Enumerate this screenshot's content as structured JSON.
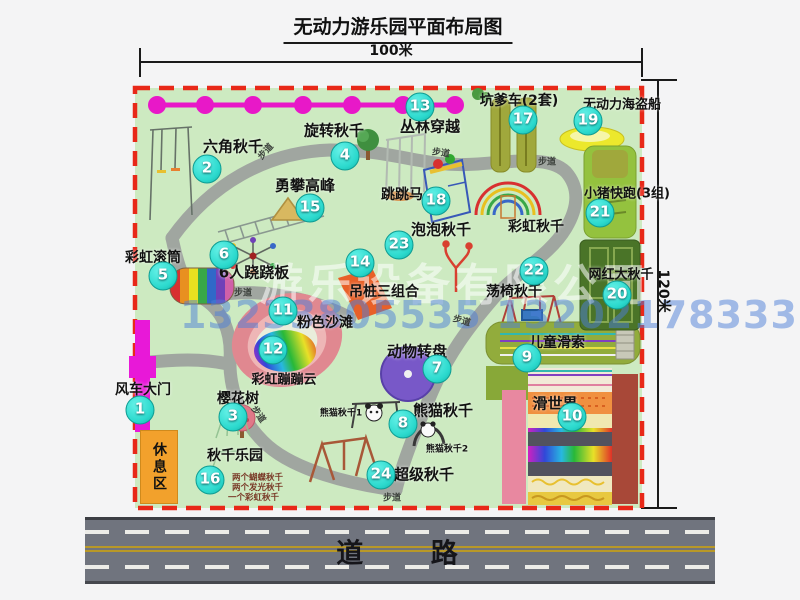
{
  "title": "无动力游乐园平面布局图",
  "scale": {
    "top": "100米",
    "right": "120米"
  },
  "watermark": {
    "company": "游乐设备有限公司",
    "phone": "13233805535 13202178333"
  },
  "road": {
    "label": "道    路"
  },
  "rest_area": {
    "label": "休息区"
  },
  "trail": {
    "label": "步道"
  },
  "extra_labels": {
    "rainbow_swing": "彩虹秋千",
    "panda_swing_1": "熊猫秋千1",
    "panda_swing_2": "熊猫秋千2"
  },
  "swing_park_notes": [
    "两个蝴蝶秋千",
    "两个发光秋千",
    "一个彩虹秋千"
  ],
  "colors": {
    "map_green": "#cdeac1",
    "border_red": "#e82818",
    "path_gray": "#a0a6a0",
    "chain_magenta": "#e818c8",
    "badge_cyan": "#2bd9cd",
    "rest_orange": "#f2a12c"
  },
  "attractions": [
    {
      "num": "1",
      "name": "风车大门"
    },
    {
      "num": "2",
      "name": "六角秋千"
    },
    {
      "num": "3",
      "name": "樱花树"
    },
    {
      "num": "4",
      "name": "旋转秋千"
    },
    {
      "num": "5",
      "name": "彩虹滚筒"
    },
    {
      "num": "6",
      "name": "6人跷跷板"
    },
    {
      "num": "7",
      "name": "动物转盘"
    },
    {
      "num": "8",
      "name": "熊猫秋千"
    },
    {
      "num": "9",
      "name": "儿童滑索"
    },
    {
      "num": "10",
      "name": "滑世界"
    },
    {
      "num": "11",
      "name": "粉色沙滩"
    },
    {
      "num": "12",
      "name": "彩虹蹦蹦云"
    },
    {
      "num": "13",
      "name": "丛林穿越"
    },
    {
      "num": "14",
      "name": "吊桩三组合"
    },
    {
      "num": "15",
      "name": "勇攀高峰"
    },
    {
      "num": "16",
      "name": "秋千乐园"
    },
    {
      "num": "17",
      "name": "坑爹车(2套)"
    },
    {
      "num": "18",
      "name": "跳跳马"
    },
    {
      "num": "19",
      "name": "无动力海盗船"
    },
    {
      "num": "20",
      "name": "网红大秋千"
    },
    {
      "num": "21",
      "name": "小猪快跑(3组)"
    },
    {
      "num": "22",
      "name": "荡椅秋千"
    },
    {
      "num": "23",
      "name": "泡泡秋千"
    },
    {
      "num": "24",
      "name": "超级秋千"
    }
  ]
}
